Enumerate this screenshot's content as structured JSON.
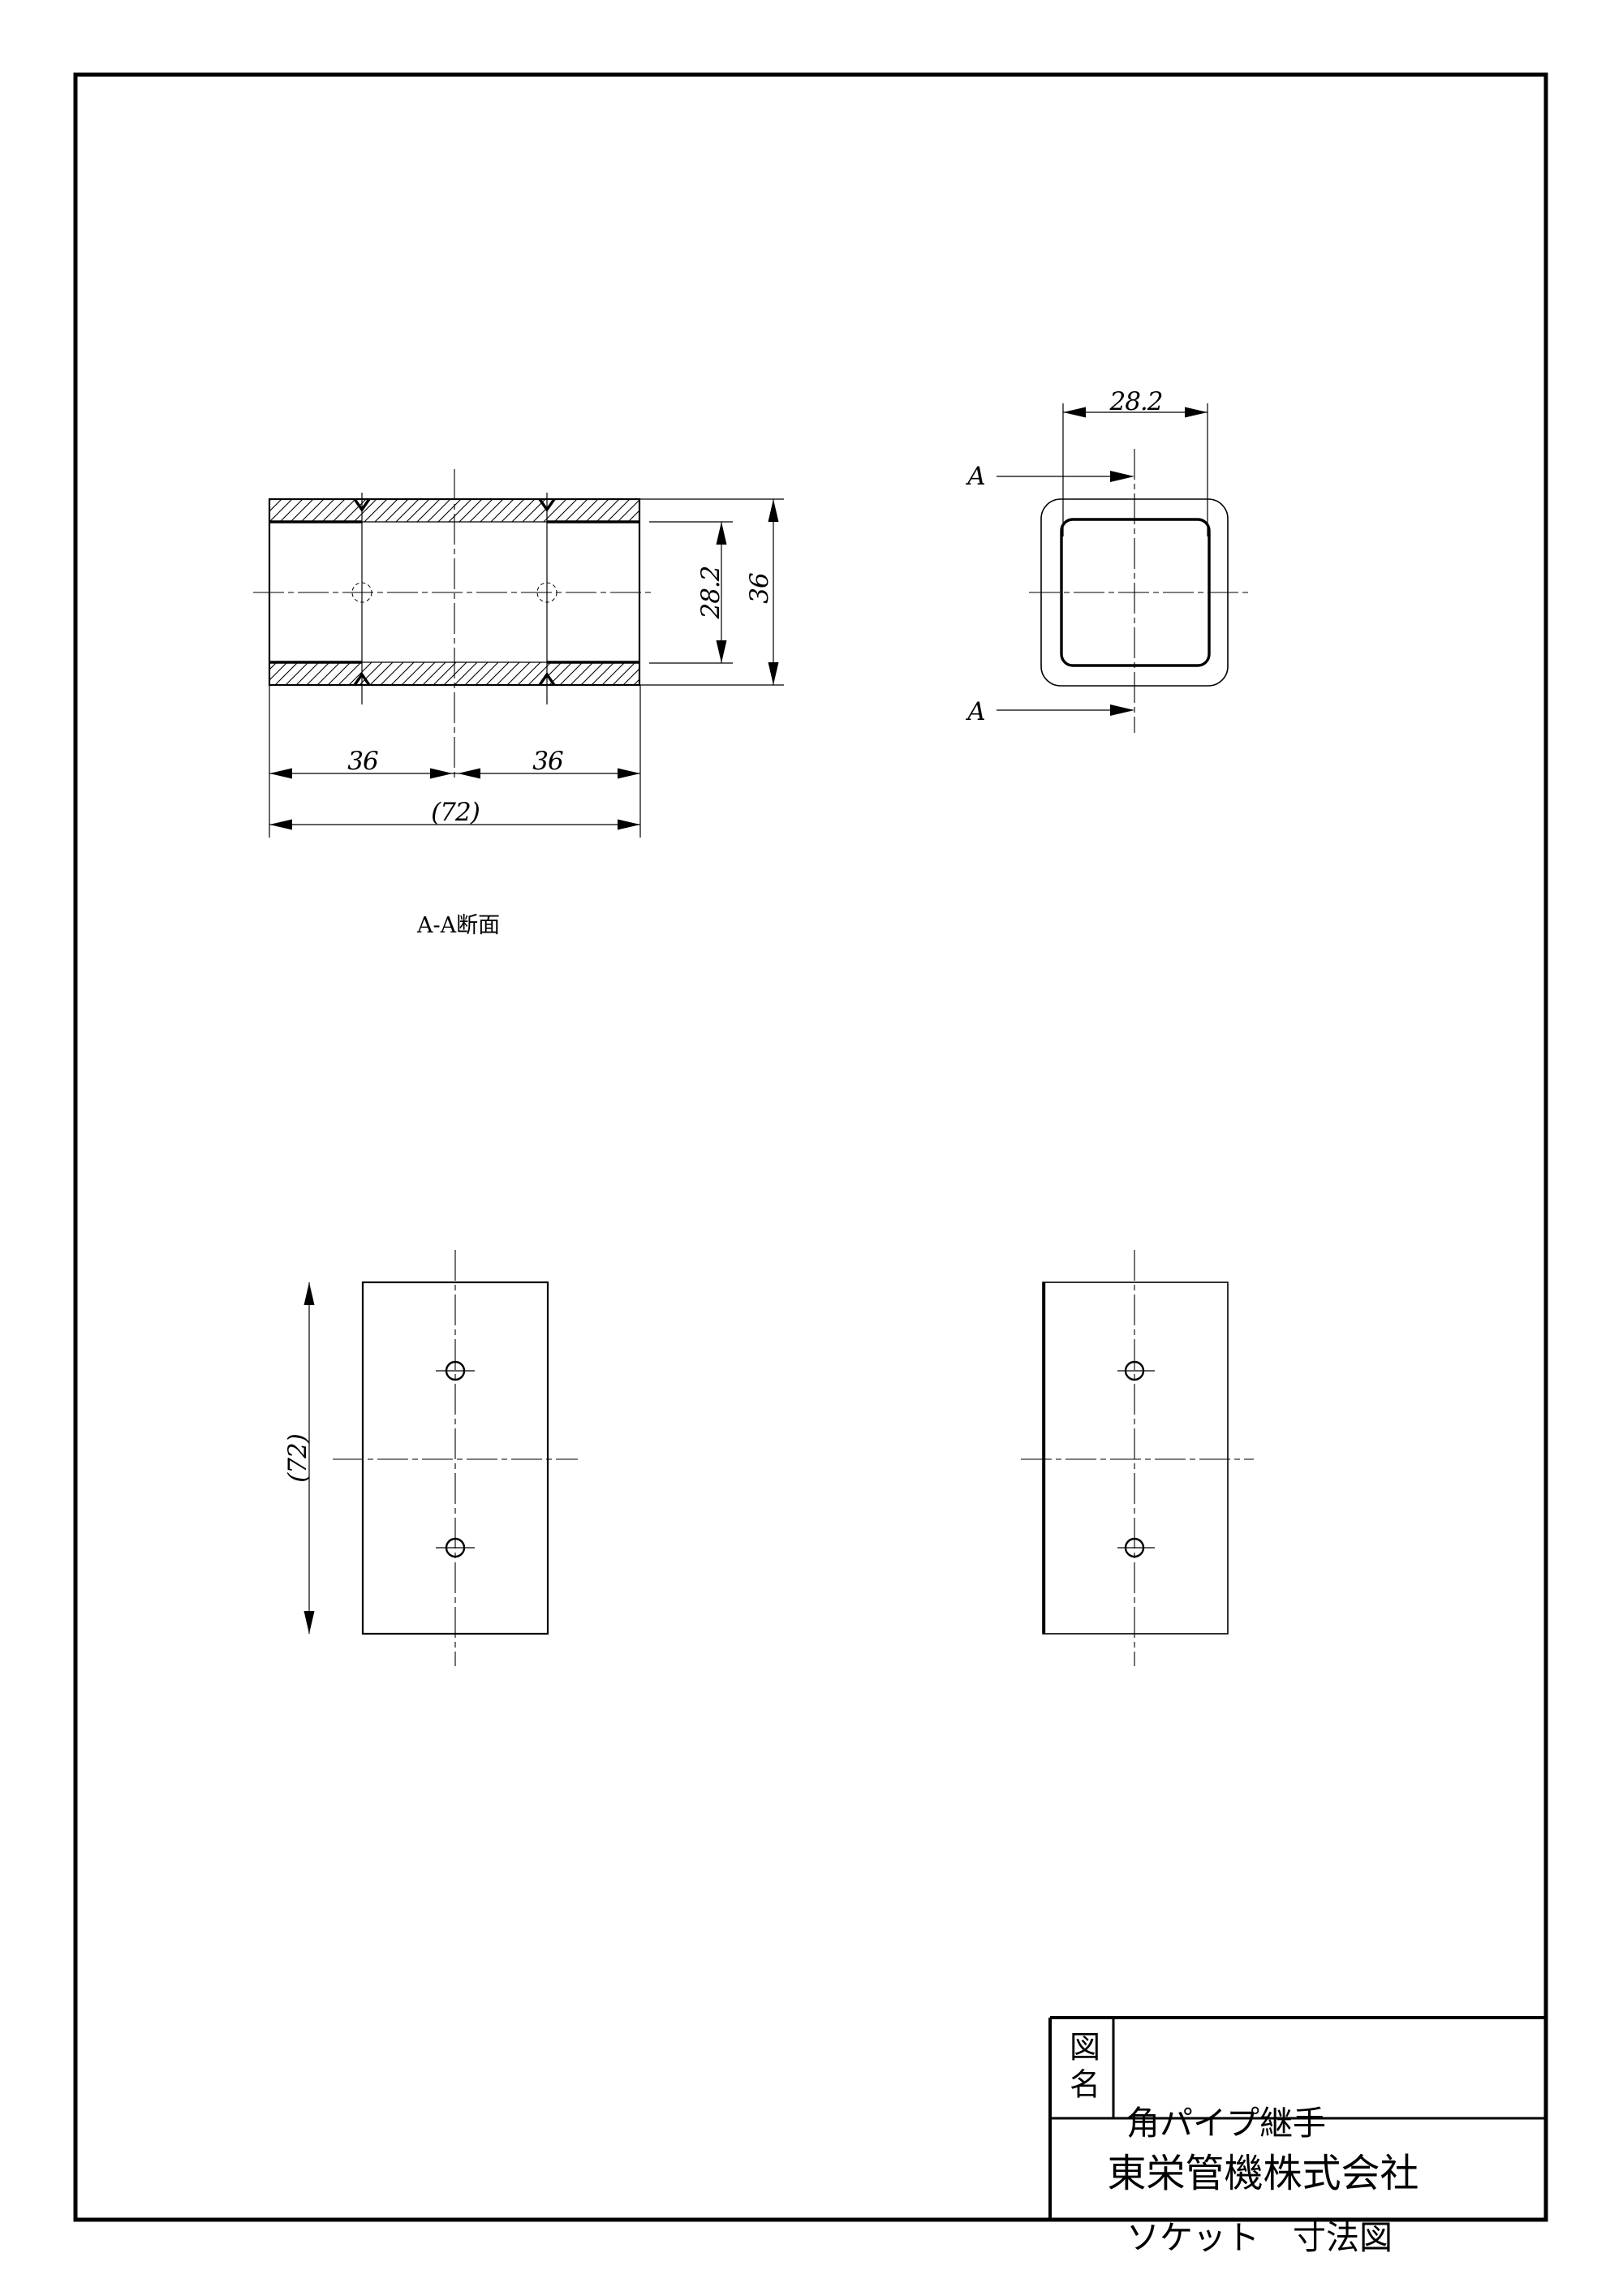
{
  "colors": {
    "line": "#000000",
    "background": "#ffffff"
  },
  "drawing": {
    "section_view": {
      "label": "A-A断面",
      "dim_segment_left": "36",
      "dim_segment_right": "36",
      "dim_overall_width": "(72)",
      "dim_inner_height": "28.2",
      "dim_outer_height": "36"
    },
    "end_view": {
      "dim_inner_width": "28.2",
      "cut_marker_top": "A",
      "cut_marker_bottom": "A"
    },
    "left_view": {
      "dim_length": "(72)"
    }
  },
  "title_block": {
    "label": "図名",
    "name_line1": "角パイプ継手",
    "name_line2": "ソケット　寸法図",
    "company": "東栄管機株式会社"
  }
}
